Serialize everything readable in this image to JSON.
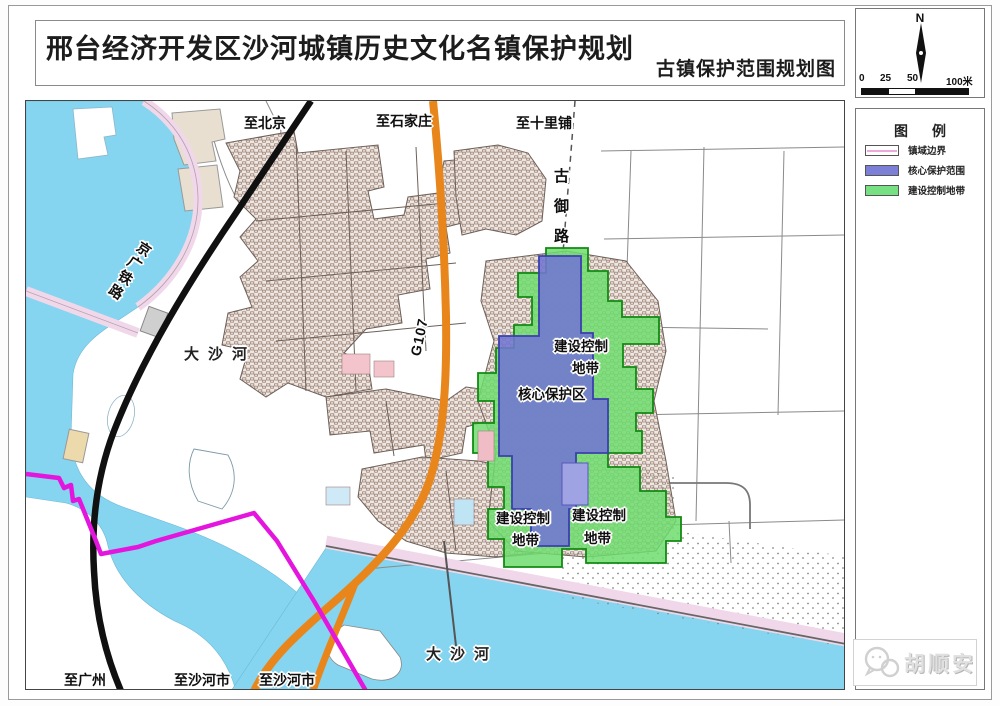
{
  "title_block": {
    "title": "邢台经济开发区沙河城镇历史文化名镇保护规划",
    "subtitle": "古镇保护范围规划图"
  },
  "north_panel": {
    "north_label": "N",
    "scale_ticks": [
      "0",
      "25",
      "50",
      "100米"
    ]
  },
  "legend": {
    "title": "图  例",
    "items": [
      {
        "label": "镇域边界",
        "color": "#ffffff",
        "line_color": "#e415dd"
      },
      {
        "label": "核心保护范围",
        "color": "#7b7fd6"
      },
      {
        "label": "建设控制地带",
        "color": "#77e083"
      }
    ]
  },
  "map_labels": {
    "to_beijing": "至北京",
    "to_shijiazhuang": "至石家庄",
    "to_shilipu": "至十里铺",
    "jingguang_railway": "京广铁路",
    "dashahe_west": "大沙河",
    "g107": "G107",
    "guyulu": [
      "古",
      "御",
      "路"
    ],
    "ctrl_zone_line1": "建设控制",
    "ctrl_zone_line2": "地带",
    "core_zone": "核心保护区",
    "dashahe_south": "大沙河",
    "to_guangzhou": "至广州",
    "to_shahe_city": "至沙河市"
  },
  "watermark": {
    "name": "胡顺安",
    "icon": "wechat-icon"
  },
  "colors": {
    "river": "#85d4f0",
    "core_protection_zone": "#7276d2",
    "construction_control_zone": "#6fdd6f",
    "town_boundary_line": "#e415dd",
    "g107_road": "#e8861c",
    "railway": "#111111",
    "embankment": "#f0d8ea",
    "urban_fabric": "#9b8175"
  }
}
